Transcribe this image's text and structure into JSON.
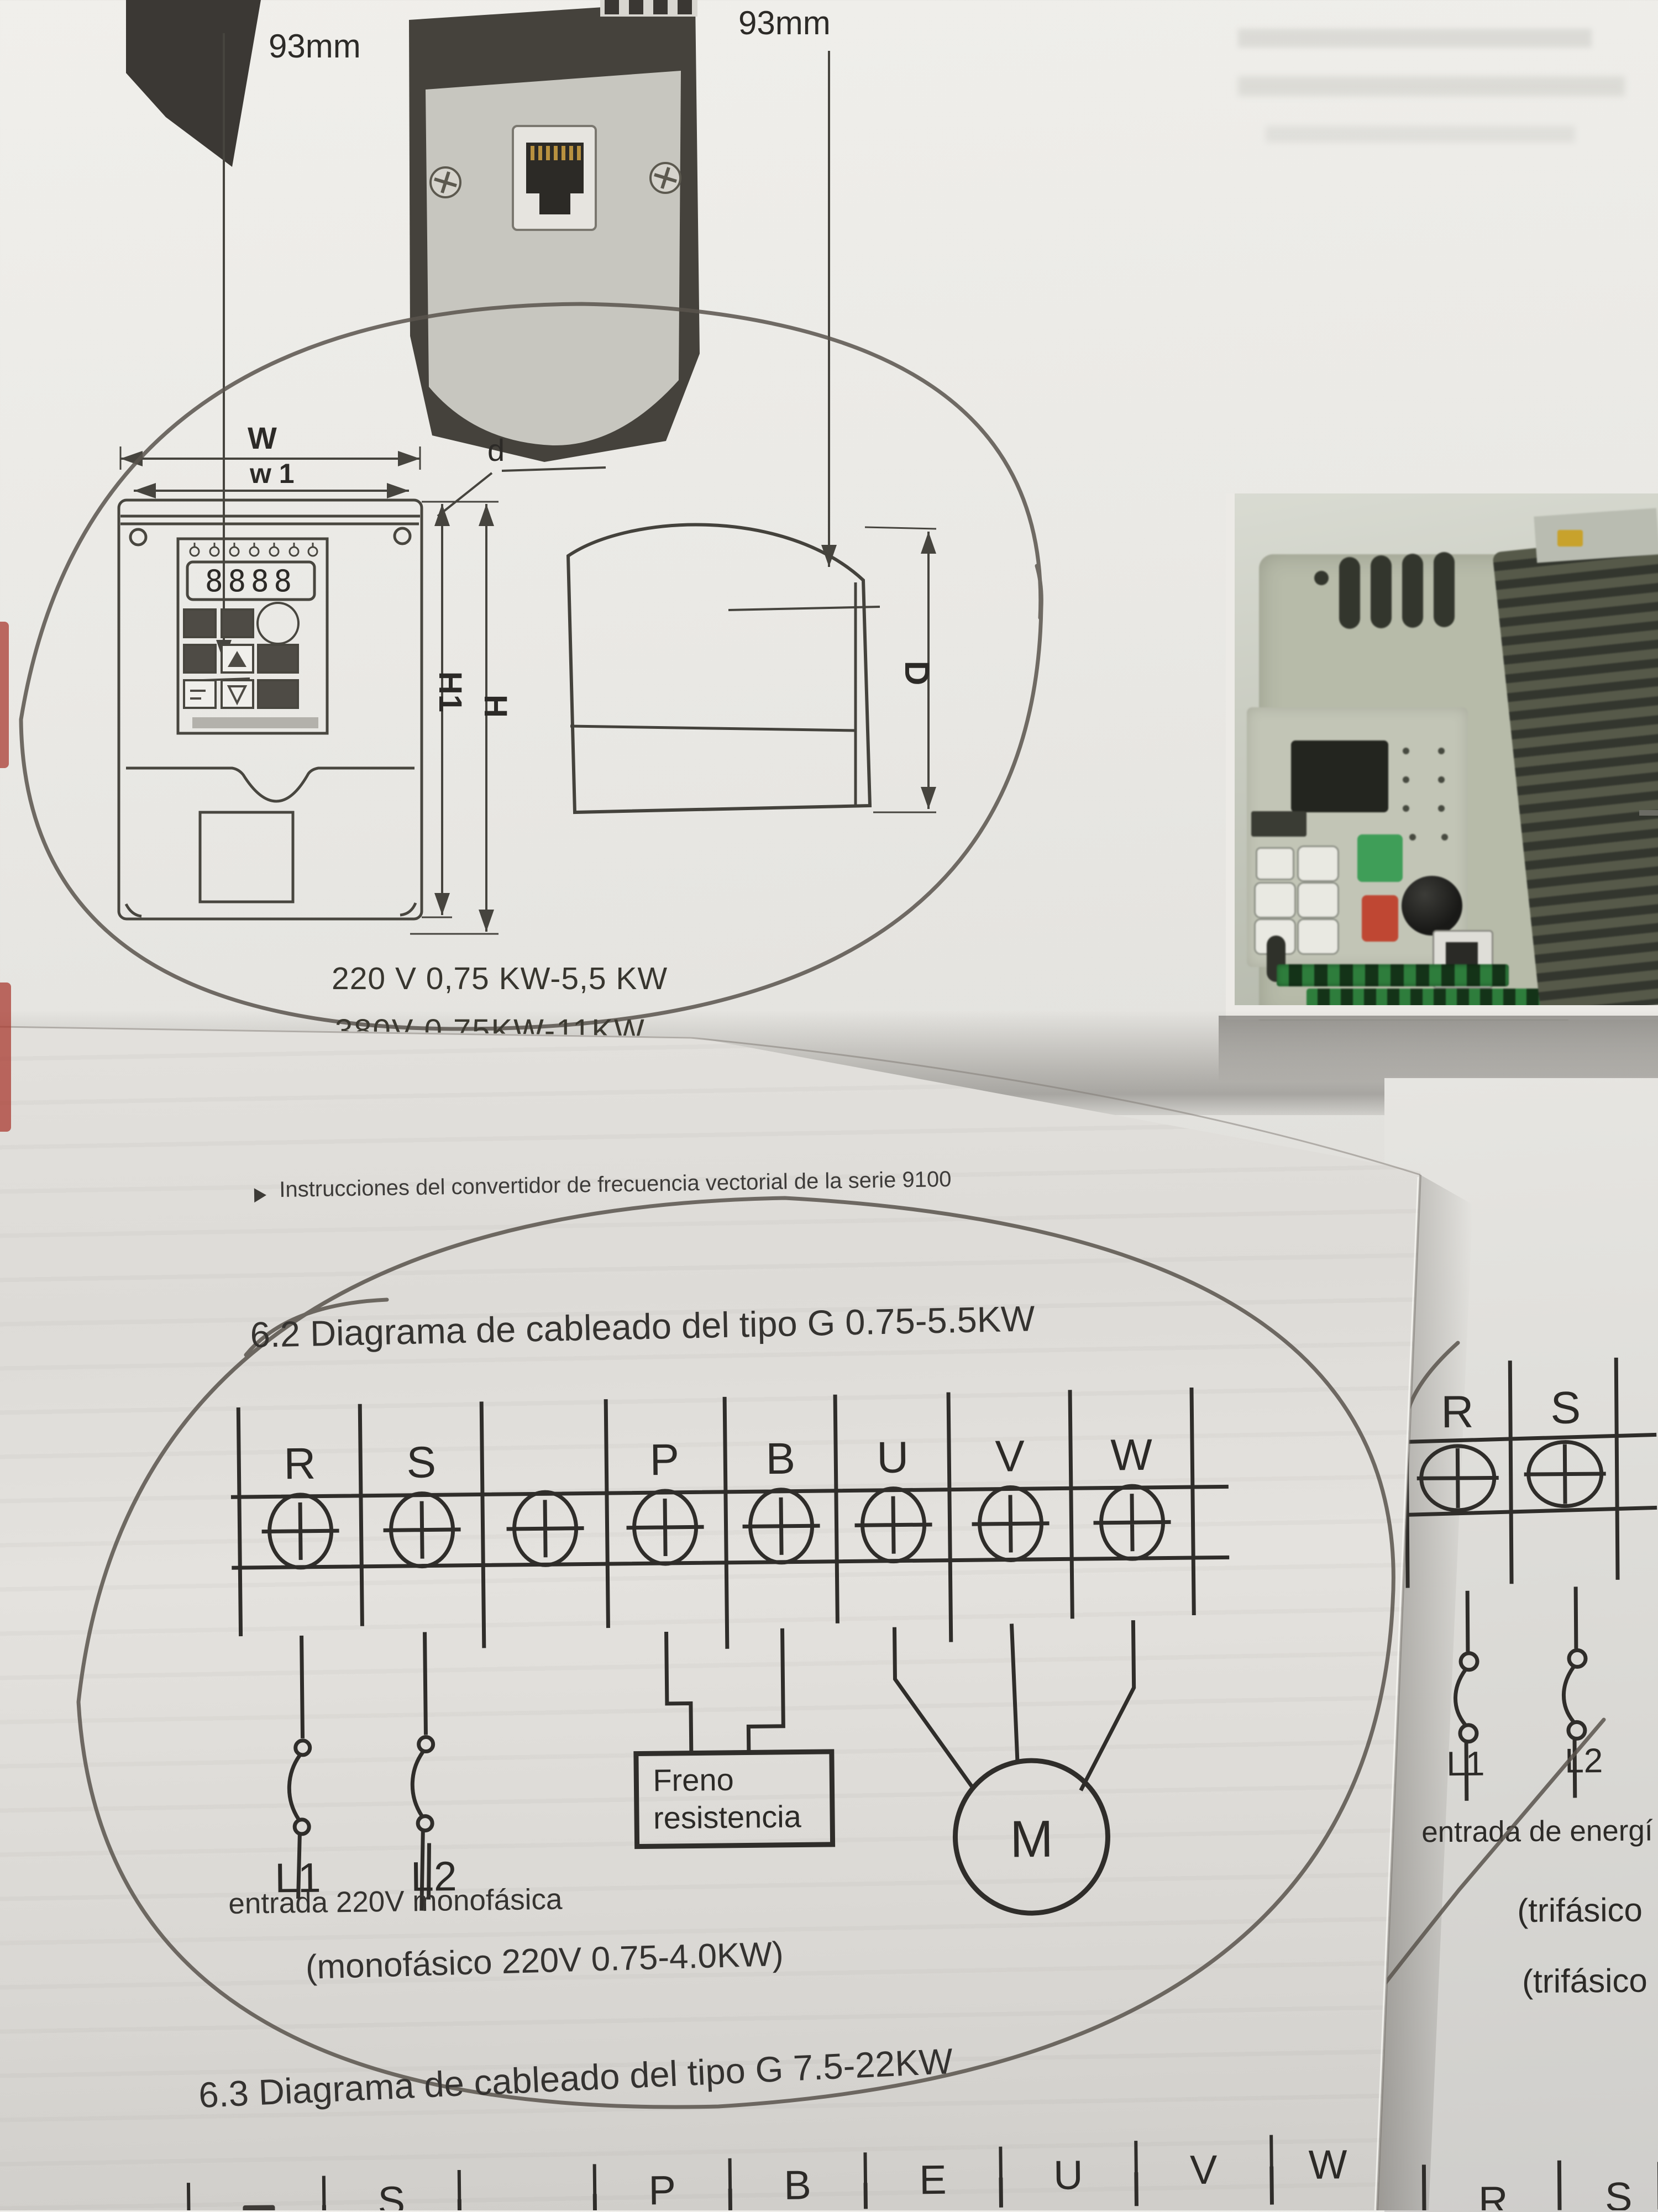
{
  "page_a": {
    "dim_label_left": "93mm",
    "dim_label_right": "93mm",
    "labels": {
      "w": "W",
      "w1": "w 1",
      "d": "d",
      "h1": "H1",
      "h": "H",
      "depth": "D"
    },
    "display_digits": "8888",
    "caption_power_220": "220 V 0,75 KW-5,5 KW",
    "caption_power_380": "380V 0,75KW-11KW"
  },
  "page_b": {
    "intro": "Instrucciones del convertidor de frecuencia vectorial de la serie 9100",
    "heading_62": "6.2 Diagrama de cableado del tipo G 0.75-5.5KW",
    "terminals": [
      "R",
      "S",
      "",
      "P",
      "B",
      "U",
      "V",
      "W"
    ],
    "brake_line1": "Freno",
    "brake_line2": "resistencia",
    "motor": "M",
    "l1": "L1",
    "l2": "L2",
    "input_label": "entrada 220V monofásica",
    "caption_mono": "(monofásico 220V 0.75-4.0KW)",
    "heading_63": "6.3 Diagrama de cableado del tipo G 7.5-22KW",
    "bottom_terminals": [
      "",
      "S",
      "",
      "P",
      "B",
      "E",
      "U",
      "V",
      "W"
    ]
  },
  "page_c": {
    "terminals": [
      "R",
      "S"
    ],
    "l1": "L1",
    "l2": "L2",
    "input_label": "entrada de energí",
    "phase_caption_1": "(trifásico",
    "phase_caption_2": "(trifásico",
    "bottom_terminals": [
      "R",
      "S"
    ]
  },
  "colors": {
    "ink": "#2c2a27",
    "pen_annotation": "#59534c",
    "paper": "#e7e6e2",
    "run_button_green": "#3f9e58",
    "stop_button_red": "#bf4733",
    "terminal_block_green": "#2e7d3c",
    "heatsink_gray": "#4b4e44"
  }
}
